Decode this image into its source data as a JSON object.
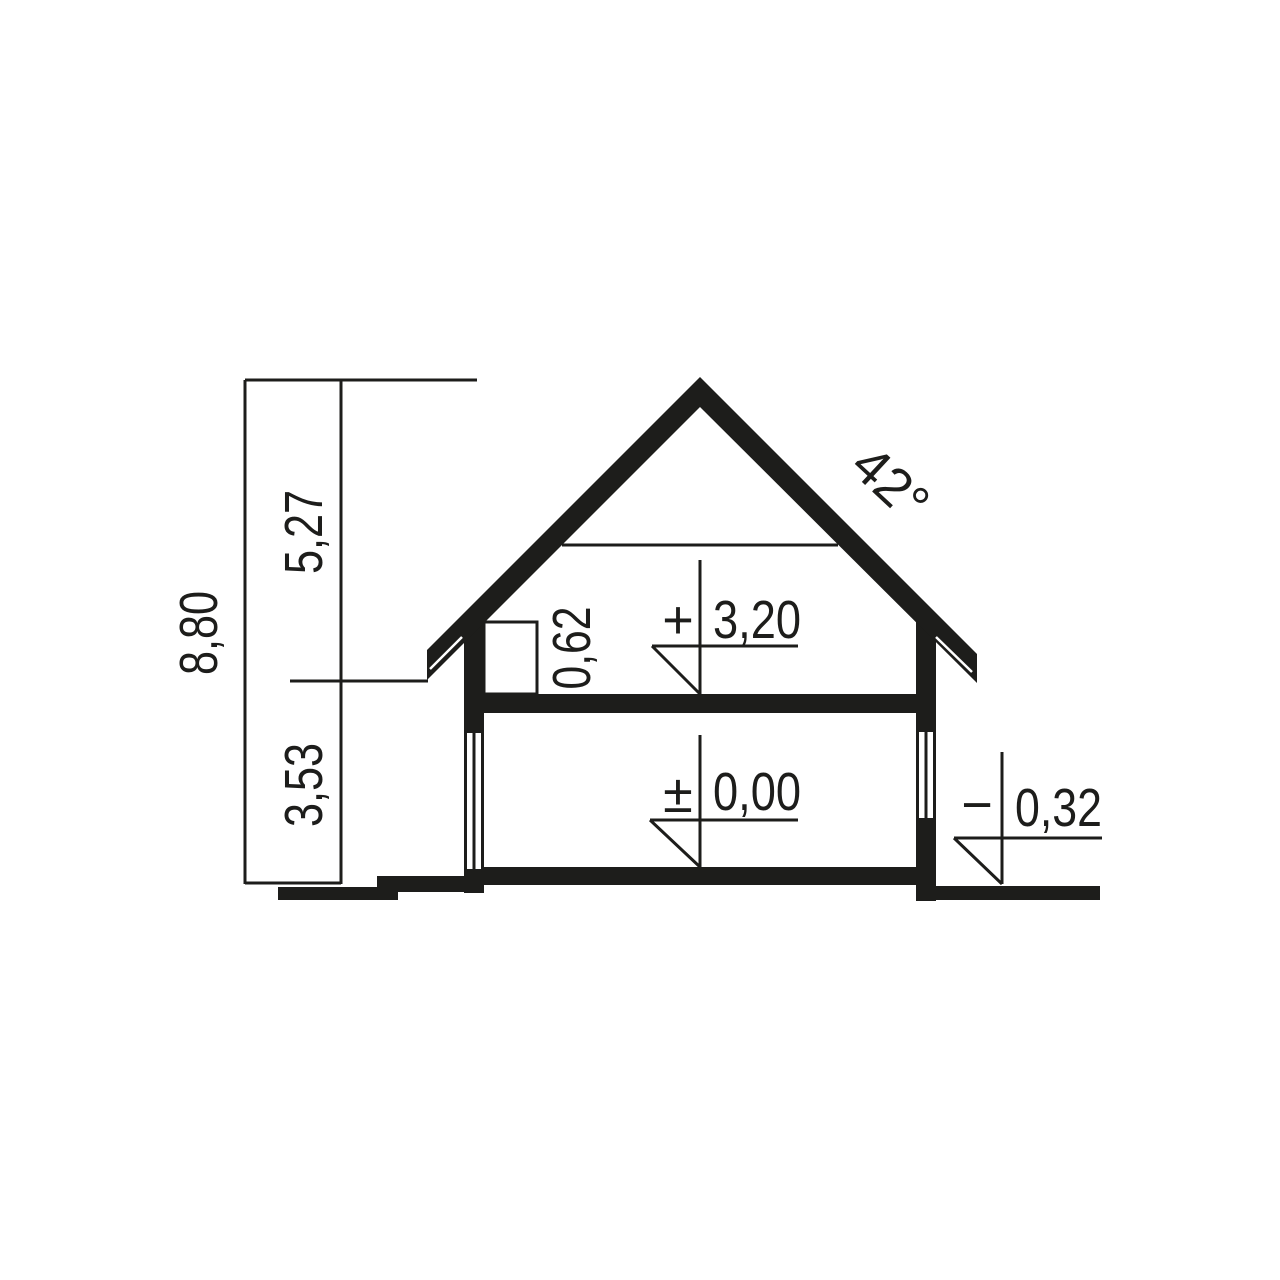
{
  "drawing": {
    "title": "House cross-section elevation drawing",
    "colors": {
      "ink": "#1d1d1b",
      "background": "#ffffff"
    },
    "dimensions": {
      "total_height": "8,80",
      "upper_height": "5,27",
      "lower_height": "3,53",
      "knee_wall_height": "0,62",
      "roof_angle": "42°"
    },
    "levels": {
      "attic_floor_sign": "+",
      "attic_floor": "3,20",
      "ground_floor_sign": "±",
      "ground_floor": "0,00",
      "exterior_grade_sign": "−",
      "exterior_grade": "0,32"
    }
  }
}
